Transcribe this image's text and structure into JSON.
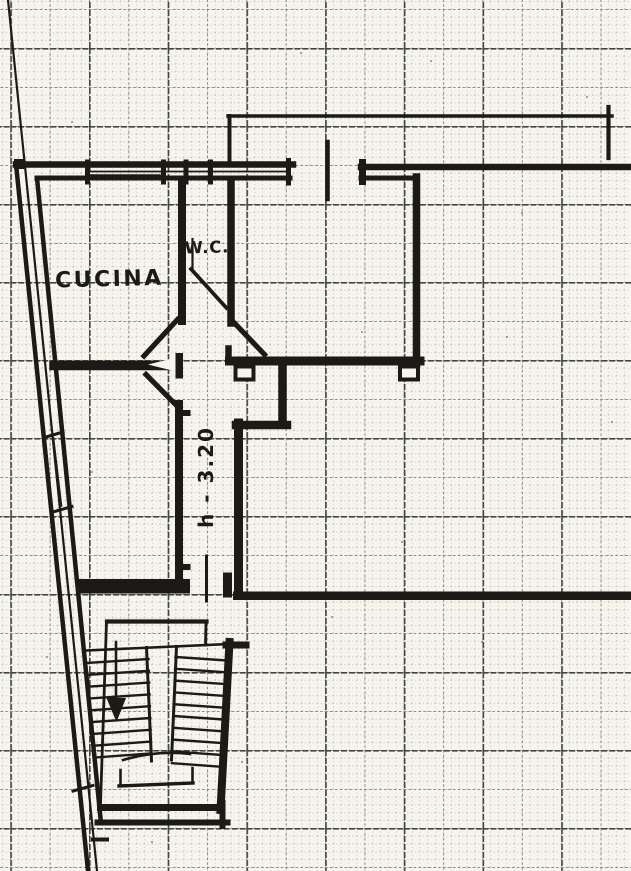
{
  "plan": {
    "labels": {
      "kitchen": "CUCINA",
      "wc": "W.C.",
      "height_note": "h - 3.20"
    },
    "colors": {
      "paper": "#f5f4ed",
      "ink": "#1c1a16",
      "grid_fine": "#b2b2a7",
      "grid_medium": "#82827a",
      "grid_bold": "#45453f"
    },
    "elements": [
      "graph-paper-grid",
      "site-boundary-line",
      "exterior-wall-with-windows",
      "top-wall-with-windows",
      "canopy-overhang-line",
      "entrance-door-leaf",
      "right-room",
      "wc-room",
      "splayed-entrance-opening",
      "corridor",
      "u-shaped-staircase",
      "stair-direction-arrow"
    ]
  }
}
